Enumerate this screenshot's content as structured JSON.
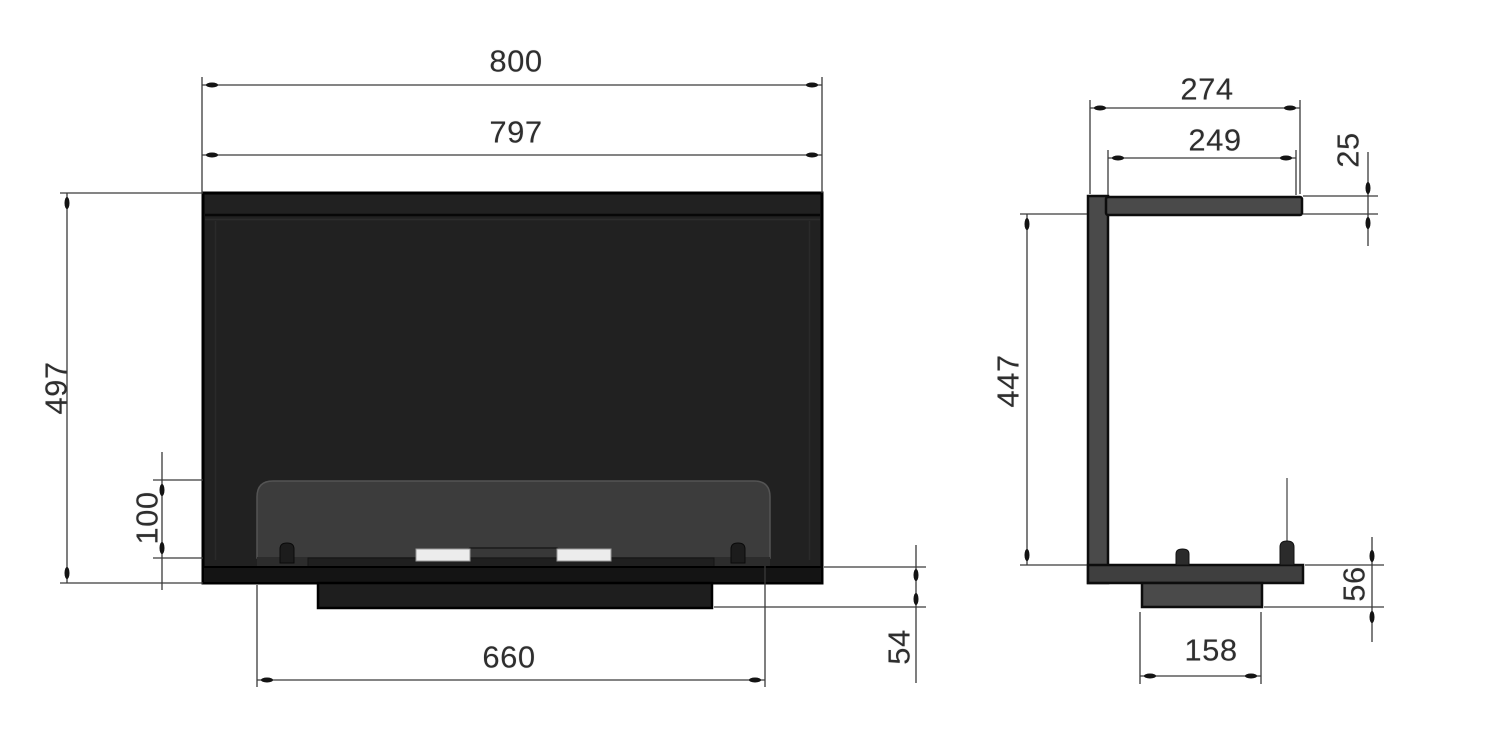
{
  "drawing": {
    "subject": "fireplace-insert-dimension-drawing",
    "background": "#ffffff",
    "line_color": "#3a3a3a",
    "body_color": "#212121",
    "glass_color": "#3c3c3c",
    "metal_color": "#4a4a4a",
    "lid_color": "#ececec"
  },
  "views": {
    "front": {
      "name": "front-view",
      "dimensions": {
        "outer_width": "800",
        "front_width": "797",
        "height": "497",
        "opening_height": "100",
        "burner_width": "660",
        "base_height": "54"
      }
    },
    "side": {
      "name": "side-view",
      "dimensions": {
        "outer_depth": "274",
        "inner_depth": "249",
        "top_thickness": "25",
        "inner_height": "447",
        "base_height": "56",
        "base_depth": "158"
      }
    }
  }
}
